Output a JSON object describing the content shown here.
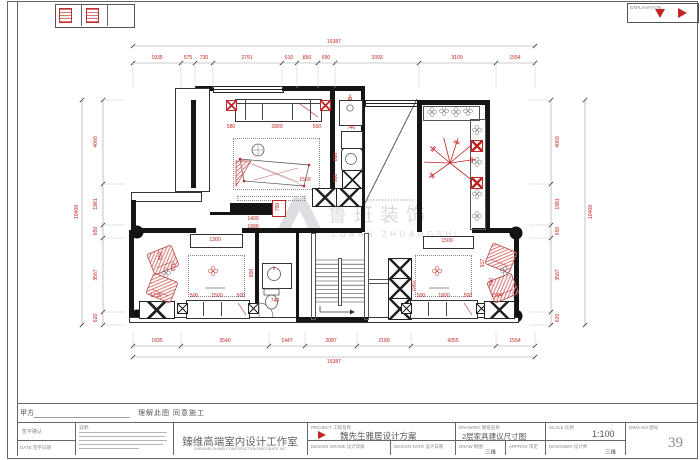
{
  "sheet": {
    "explanation": "EXPLANATION"
  },
  "approval": {
    "party": "甲方",
    "statement": "理解此图  同意施工"
  },
  "titleblock": {
    "sign": "签字确认",
    "date": "DATE  签字日期",
    "notes": "说明:",
    "company_cn": "臻维高端室内设计工作室",
    "company_en": "ZHENWEI SHINEI CONSTRUCTION DECORATE INC",
    "project_label": "PROJECT  工程名称",
    "project_value": "魏先生雅居设计方案",
    "drawing_label": "DRAWING  图纸名称",
    "drawing_value": "2层家具建议尺寸图",
    "scale_label": "SCALE  比例",
    "scale_value": "1:100",
    "dwg_label": "DWG.NO  图号",
    "dwg_value": "39",
    "grade_label": "DESIGN GRADE  设计等级",
    "ddate_label": "DESIGN DATE  设计日期",
    "draw_label": "DRAW  制图",
    "draw_value": "三维",
    "approv_label": "APPROV  审定",
    "designer_label": "DESIGNER  设计师",
    "designer_value": "三维"
  },
  "watermark": {
    "cn": "鲁班装饰",
    "en": "LUBAN ZHUANGSHI"
  },
  "dims": {
    "top_total": "16387",
    "bottom_total": "16387",
    "left_total": "10408",
    "right_total": "10408",
    "top": [
      "1935",
      "575",
      "730",
      "2791",
      "610",
      "850",
      "690",
      "3393",
      "3109",
      "1554"
    ],
    "bottom": [
      "1935",
      "3540",
      "1447",
      "2087",
      "2180",
      "4355",
      "1554"
    ],
    "left": [
      "4060",
      "1981",
      "650",
      "3567",
      "620"
    ],
    "right": [
      "4060",
      "1981",
      "650",
      "3567",
      "620"
    ]
  },
  "plan_labels": [
    "580",
    "2800",
    "500",
    "746",
    "800",
    "600",
    "1550",
    "700",
    "1400",
    "1888",
    "1300",
    "1500",
    "1735",
    "850",
    "871",
    "500",
    "1500",
    "500",
    "800",
    "740",
    "1982",
    "500",
    "1800",
    "500",
    "917",
    "790",
    "1554"
  ],
  "colors": {
    "dim_red": "#c22525",
    "wall": "#151515",
    "watermark": "#ccd0d6"
  }
}
